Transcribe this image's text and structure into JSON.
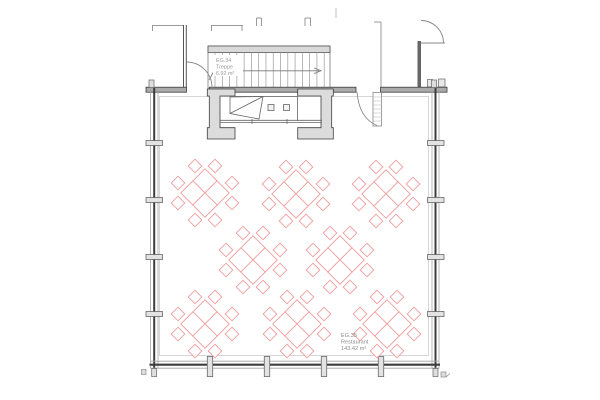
{
  "plan": {
    "rooms": {
      "stair": {
        "id": "EG.34",
        "name": "Treppe",
        "area": "6.92 m²"
      },
      "restaurant": {
        "id": "EG.35",
        "name": "Restaurant",
        "area": "143.42 m²"
      }
    },
    "furniture": {
      "round_tables": {
        "count": 8,
        "seats_per_table": 8,
        "positions": [
          [
            205,
            193
          ],
          [
            296,
            194
          ],
          [
            386,
            194
          ],
          [
            253,
            260
          ],
          [
            340,
            260
          ],
          [
            205,
            324
          ],
          [
            297,
            324
          ],
          [
            387,
            324
          ]
        ]
      }
    },
    "walls": {
      "mullions_left_y": [
        143,
        200,
        257,
        314
      ],
      "mullions_right_y": [
        143,
        200,
        257,
        314
      ],
      "mullions_bottom_x": [
        210,
        267,
        324,
        381
      ]
    },
    "colors": {
      "table_outline": "#ee9e9e",
      "wall_dark": "#3d3d3d",
      "wall_fill": "#ababab",
      "light_fill": "#dcdcdc",
      "line_gray": "#9a9a9a",
      "label_text": "#8a8a8a"
    }
  }
}
